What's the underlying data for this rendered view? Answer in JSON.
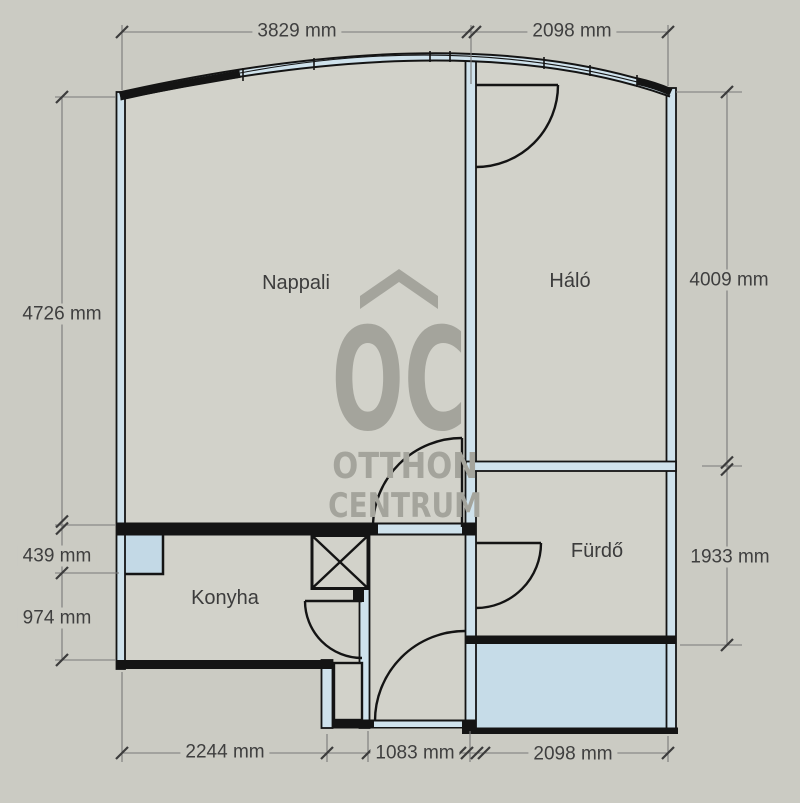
{
  "watermark": {
    "monogram": "OC",
    "name_line1": "OTTHON",
    "name_line2": "CENTRUM"
  },
  "rooms": {
    "living": "Nappali",
    "bedroom": "Háló",
    "bathroom": "Fürdő",
    "kitchen": "Konyha"
  },
  "dimensions": {
    "top": [
      "3829 mm",
      "2098 mm"
    ],
    "left": [
      "4726 mm",
      "439 mm",
      "974 mm"
    ],
    "right": [
      "4009 mm",
      "1933 mm"
    ],
    "bottom": [
      "2244 mm",
      "1083 mm",
      "2098 mm"
    ]
  },
  "unit": "mm",
  "colors": {
    "background": "#cbcbc3",
    "floor": "#d2d2ca",
    "wall-core": "#cfe2ec",
    "window": "#c3d9e6",
    "balcony": "#c6dce8",
    "line": "#141414",
    "dimension-text": "#3f3f3f",
    "logo": "#a4a49c"
  }
}
